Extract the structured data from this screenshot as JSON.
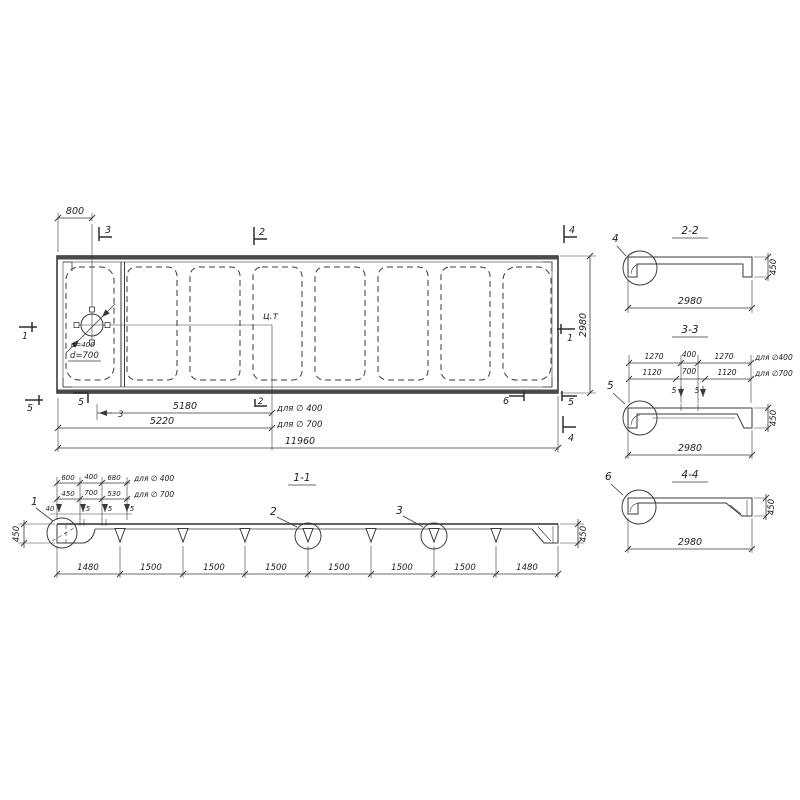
{
  "plan": {
    "dim_800": "800",
    "dim_2980": "2980",
    "dim_5180": "5180",
    "dim_5220": "5220",
    "dim_11960": "11960",
    "label_for_400": "для ∅ 400",
    "label_for_700": "для ∅ 700",
    "label_center": "ц.т",
    "hole_d400": "d=400",
    "hole_d700": "d=700",
    "marks": {
      "top_3": "3",
      "top_2": "2",
      "top_4": "4",
      "left_1": "1",
      "right_1": "1",
      "bottom_5a": "5",
      "bottom_5b": "5",
      "bottom_3": "3",
      "bottom_2": "2",
      "bottom_6": "6",
      "bottom_5c": "5",
      "bottom_4": "4"
    }
  },
  "section_1_1": {
    "title": "1-1",
    "row_400": {
      "a": "600",
      "b": "400",
      "c": "680",
      "label": "для ∅ 400"
    },
    "row_700": {
      "a": "450",
      "b": "700",
      "c": "530",
      "label": "для ∅ 700"
    },
    "small_dims": [
      "40",
      "5",
      "5",
      "5"
    ],
    "bottom_dims": [
      "1480",
      "1500",
      "1500",
      "1500",
      "1500",
      "1500",
      "1500",
      "1480"
    ],
    "height_left": "450",
    "height_right": "450",
    "detail_1": "1",
    "detail_2": "2",
    "detail_3": "3"
  },
  "section_2_2": {
    "title": "2-2",
    "detail": "4",
    "dim_width": "2980",
    "dim_height": "450"
  },
  "section_3_3": {
    "title": "3-3",
    "detail": "5",
    "dim_width": "2980",
    "dim_height": "450",
    "row_400": {
      "a": "1270",
      "b": "400",
      "c": "1270",
      "label": "для ∅400"
    },
    "row_700": {
      "a": "1120",
      "b": "700",
      "c": "1120",
      "label": "для ∅700"
    },
    "gap_a": "5",
    "gap_b": "5"
  },
  "section_4_4": {
    "title": "4-4",
    "detail": "6",
    "dim_width": "2980",
    "dim_height": "450"
  }
}
